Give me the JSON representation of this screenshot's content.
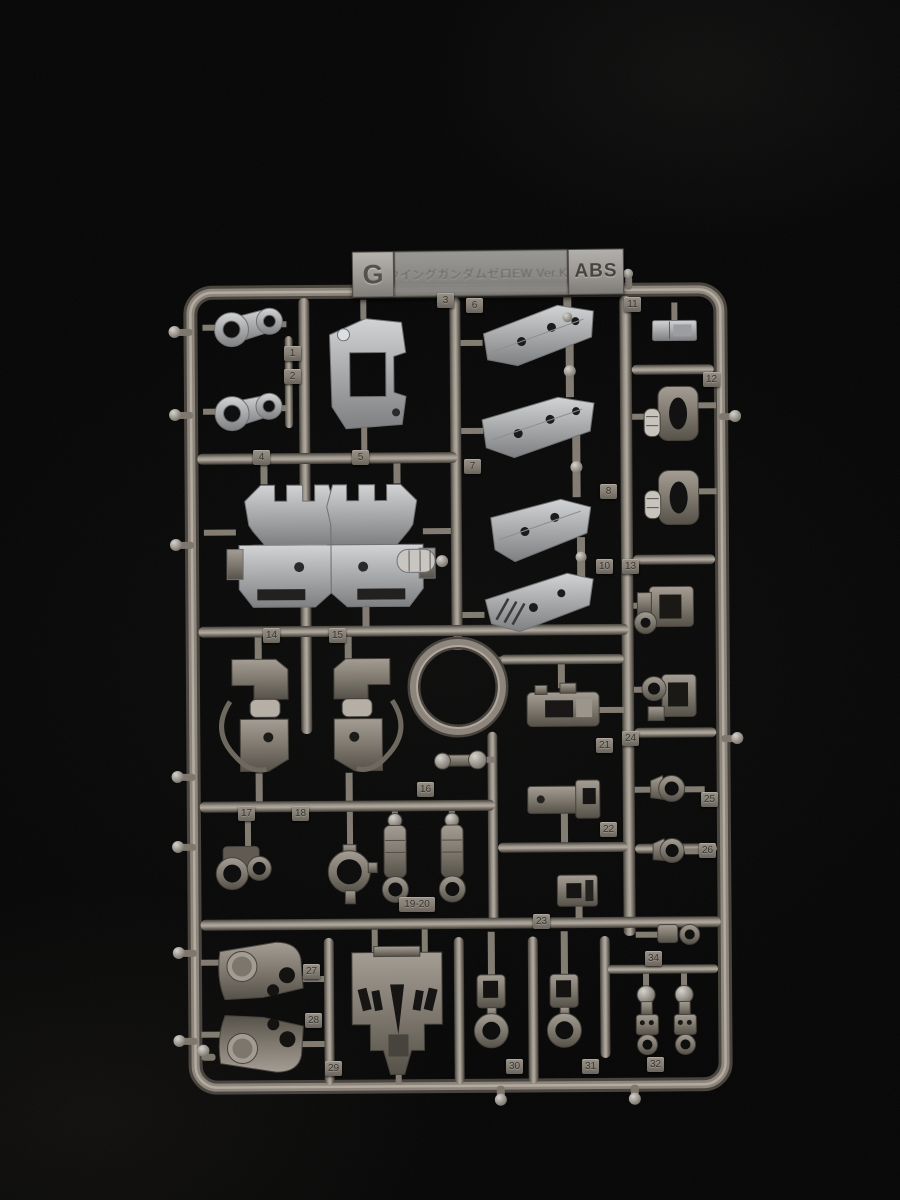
{
  "scene": {
    "type": "photograph",
    "subject": "Gray ABS model-kit runner (sprue) G photographed on black fabric"
  },
  "runner_plate": {
    "runner_letter": "G",
    "kit_title": "ウイングガンダムゼロEW Ver.Ka",
    "material": "ABS"
  },
  "part_tabs": [
    {
      "label": "1"
    },
    {
      "label": "2"
    },
    {
      "label": "3"
    },
    {
      "label": "6"
    },
    {
      "label": "11"
    },
    {
      "label": "4"
    },
    {
      "label": "5"
    },
    {
      "label": "7"
    },
    {
      "label": "8"
    },
    {
      "label": "12"
    },
    {
      "label": "10"
    },
    {
      "label": "13"
    },
    {
      "label": "14"
    },
    {
      "label": "15"
    },
    {
      "label": "16"
    },
    {
      "label": "17"
    },
    {
      "label": "18"
    },
    {
      "label": "19-20"
    },
    {
      "label": "21"
    },
    {
      "label": "22"
    },
    {
      "label": "23"
    },
    {
      "label": "24"
    },
    {
      "label": "25"
    },
    {
      "label": "26"
    },
    {
      "label": "27"
    },
    {
      "label": "28"
    },
    {
      "label": "29"
    },
    {
      "label": "30"
    },
    {
      "label": "31"
    },
    {
      "label": "32"
    },
    {
      "label": "34"
    }
  ],
  "colors": {
    "background": "#050505",
    "runner_frame": "#857f76",
    "light_parts": "#b4b6b8",
    "dark_parts": "#847e75",
    "label_plate": "#a3a19e"
  }
}
